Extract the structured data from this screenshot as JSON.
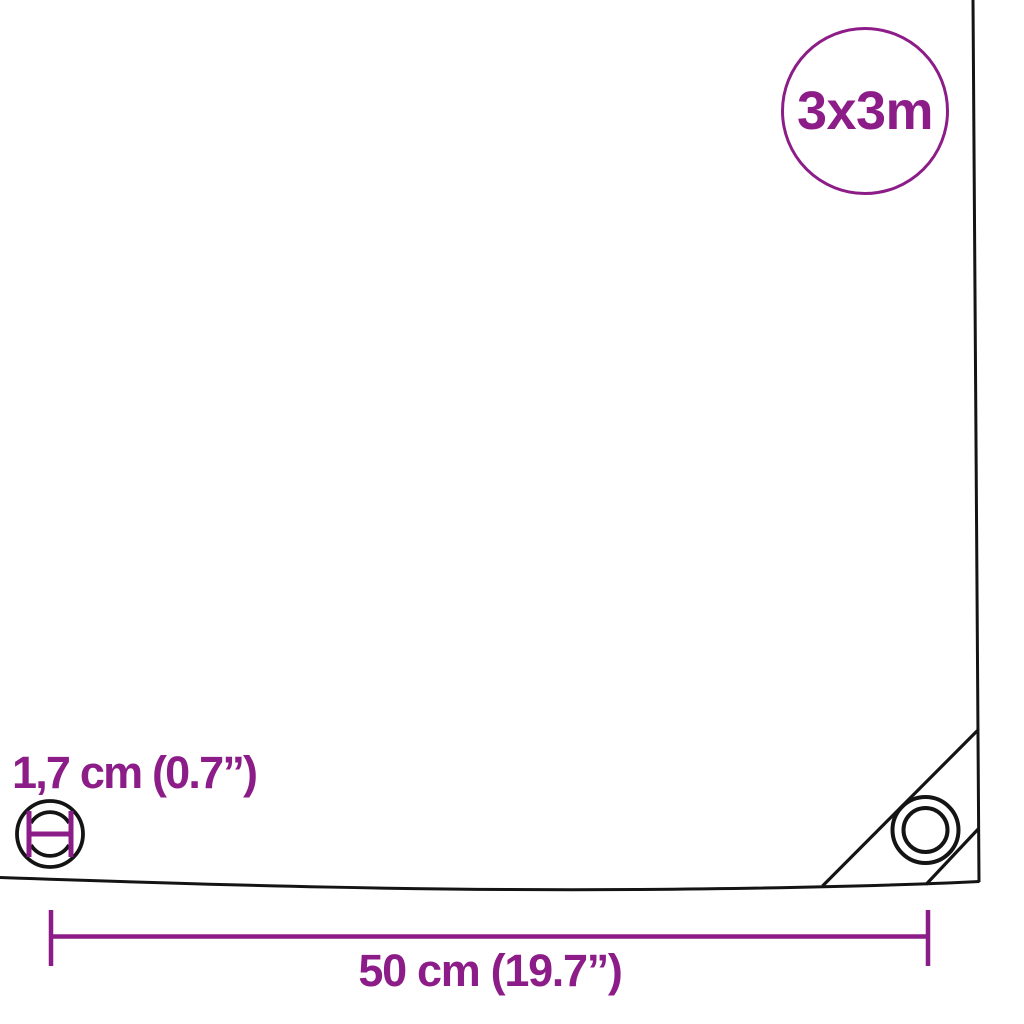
{
  "diagram": {
    "title_badge": {
      "label": "3x3m"
    },
    "labels": {
      "eyelet_diameter": "1,7 cm (0.7”)",
      "corner_offset": "50 cm (19.7”)"
    },
    "colors": {
      "accent": "#8c1d88",
      "line": "#141414",
      "background": "#ffffff"
    },
    "icons": {
      "size_badge": "size-badge-circle",
      "left_eyelet": "eyelet-grommet-icon",
      "corner_eyelet": "eyelet-grommet-icon",
      "diameter_marker": "diameter-measurement-icon",
      "width_dimension": "dimension-line-icon"
    }
  }
}
